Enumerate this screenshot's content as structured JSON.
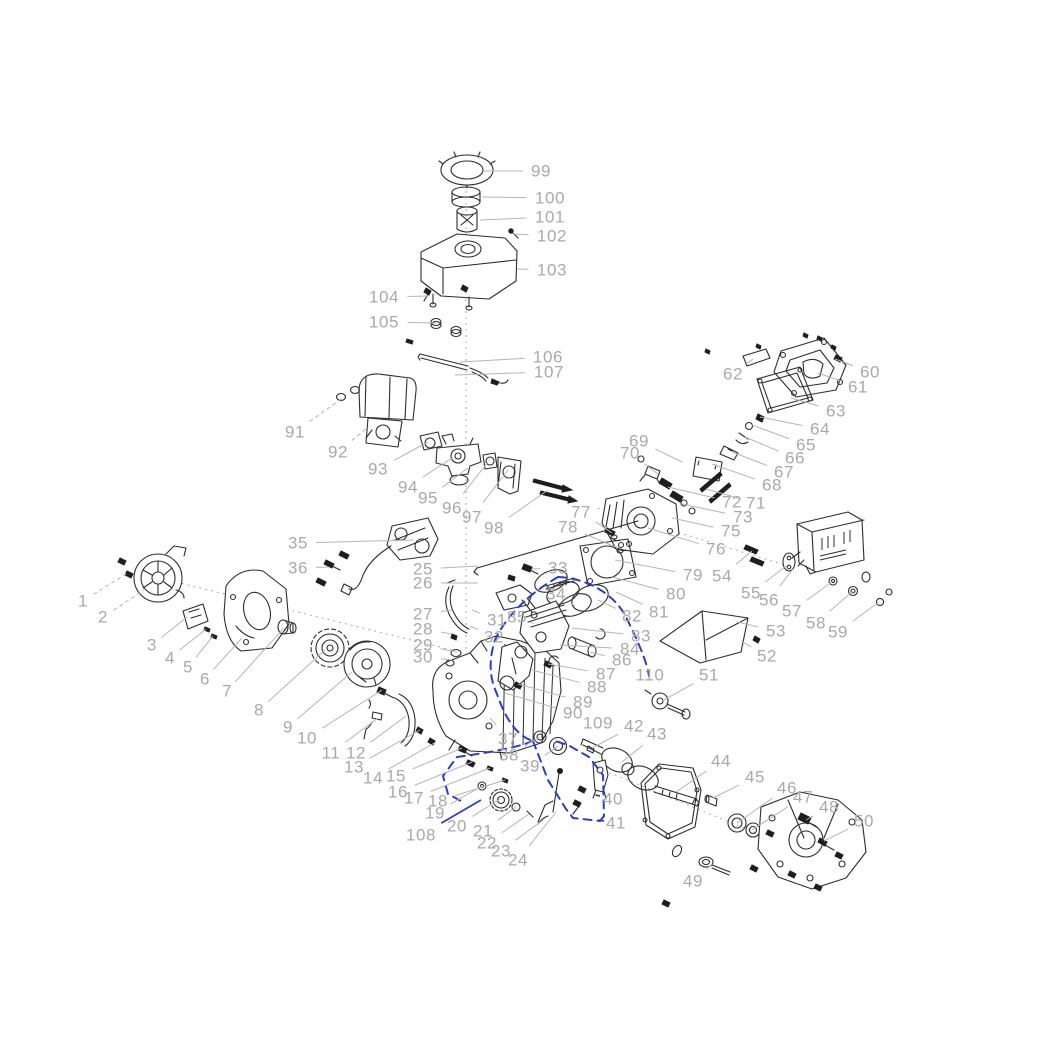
{
  "figure": {
    "type": "exploded-parts-diagram",
    "subject": "small gasoline engine"
  },
  "colors": {
    "background": "#ffffff",
    "label": "#a9a9a9",
    "leader": "#b5b5b5",
    "sketch": "#2d2d2d",
    "highlight": "#2a3bd0"
  },
  "axis_lines": [
    {
      "x1": 466,
      "y1": 185,
      "x2": 466,
      "y2": 652
    },
    {
      "x1": 176,
      "y1": 582,
      "x2": 452,
      "y2": 650
    },
    {
      "x1": 598,
      "y1": 508,
      "x2": 788,
      "y2": 566
    },
    {
      "x1": 598,
      "y1": 768,
      "x2": 756,
      "y2": 833
    }
  ],
  "highlight_paths": [
    {
      "d": "M558,577 C585,578 612,592 625,615 C638,641 647,662 649,676"
    },
    {
      "d": "M558,577 C535,590 508,612 495,640 C488,662 490,679 497,694 C506,720 517,736 533,741"
    },
    {
      "d": "M533,741 C514,749 478,754 457,757 L443,776 L448,794 L461,801"
    },
    {
      "d": "M533,741 L548,780 L566,809 L573,818 L600,821"
    },
    {
      "d": "M600,821 L604,816 L603,775 L589,757 L568,745 L552,740"
    }
  ],
  "callouts": [
    {
      "n": "1",
      "x": 83,
      "y": 601,
      "tx": 126,
      "ty": 574,
      "lt": "gd"
    },
    {
      "n": "2",
      "x": 103,
      "y": 617,
      "tx": 144,
      "ty": 590,
      "lt": "gd"
    },
    {
      "n": "3",
      "x": 152,
      "y": 645,
      "tx": 187,
      "ty": 617
    },
    {
      "n": "4",
      "x": 170,
      "y": 658,
      "tx": 206,
      "ty": 629
    },
    {
      "n": "5",
      "x": 188,
      "y": 667,
      "tx": 213,
      "ty": 636
    },
    {
      "n": "6",
      "x": 205,
      "y": 679,
      "tx": 242,
      "ty": 638
    },
    {
      "n": "7",
      "x": 227,
      "y": 691,
      "tx": 284,
      "ty": 628
    },
    {
      "n": "8",
      "x": 259,
      "y": 710,
      "tx": 325,
      "ty": 650
    },
    {
      "n": "9",
      "x": 288,
      "y": 727,
      "tx": 352,
      "ty": 672
    },
    {
      "n": "10",
      "x": 307,
      "y": 738,
      "tx": 382,
      "ty": 690
    },
    {
      "n": "11",
      "x": 331,
      "y": 753,
      "tx": 378,
      "ty": 718
    },
    {
      "n": "12",
      "x": 356,
      "y": 753,
      "tx": 406,
      "ty": 716
    },
    {
      "n": "13",
      "x": 354,
      "y": 767,
      "tx": 420,
      "ty": 730
    },
    {
      "n": "14",
      "x": 373,
      "y": 778,
      "tx": 436,
      "ty": 742
    },
    {
      "n": "15",
      "x": 396,
      "y": 776,
      "tx": 462,
      "ty": 748
    },
    {
      "n": "16",
      "x": 398,
      "y": 792,
      "tx": 472,
      "ty": 762
    },
    {
      "n": "17",
      "x": 414,
      "y": 798,
      "tx": 490,
      "ty": 768
    },
    {
      "n": "18",
      "x": 438,
      "y": 801,
      "tx": 505,
      "ty": 780
    },
    {
      "n": "19",
      "x": 435,
      "y": 813,
      "tx": 482,
      "ty": 786
    },
    {
      "n": "20",
      "x": 457,
      "y": 826,
      "tx": 500,
      "ty": 799
    },
    {
      "n": "21",
      "x": 483,
      "y": 831,
      "tx": 516,
      "ty": 807
    },
    {
      "n": "22",
      "x": 487,
      "y": 843,
      "tx": 529,
      "ty": 814
    },
    {
      "n": "23",
      "x": 501,
      "y": 851,
      "tx": 543,
      "ty": 820
    },
    {
      "n": "24",
      "x": 518,
      "y": 860,
      "tx": 556,
      "ty": 812
    },
    {
      "n": "25",
      "x": 423,
      "y": 569,
      "tx": 478,
      "ty": 566
    },
    {
      "n": "26",
      "x": 423,
      "y": 583,
      "tx": 478,
      "ty": 583
    },
    {
      "n": "27",
      "x": 423,
      "y": 614,
      "tx": 452,
      "ty": 610
    },
    {
      "n": "28",
      "x": 423,
      "y": 629,
      "tx": 452,
      "ty": 634
    },
    {
      "n": "29",
      "x": 423,
      "y": 645,
      "tx": 457,
      "ty": 652
    },
    {
      "n": "30",
      "x": 423,
      "y": 657,
      "tx": 452,
      "ty": 660
    },
    {
      "n": "31",
      "x": 497,
      "y": 620,
      "tx": 472,
      "ty": 610
    },
    {
      "n": "32",
      "x": 494,
      "y": 637,
      "tx": 470,
      "ty": 626
    },
    {
      "n": "33",
      "x": 558,
      "y": 568,
      "tx": 532,
      "ty": 569
    },
    {
      "n": "34",
      "x": 556,
      "y": 594,
      "tx": 575,
      "ty": 606
    },
    {
      "n": "35",
      "x": 298,
      "y": 543,
      "tx": 413,
      "ty": 540
    },
    {
      "n": "36",
      "x": 298,
      "y": 568,
      "tx": 329,
      "ty": 567
    },
    {
      "n": "37",
      "x": 508,
      "y": 739,
      "tx": 490,
      "ty": 718
    },
    {
      "n": "38",
      "x": 509,
      "y": 755,
      "tx": 540,
      "ty": 737
    },
    {
      "n": "39",
      "x": 530,
      "y": 766,
      "tx": 558,
      "ty": 746
    },
    {
      "n": "40",
      "x": 613,
      "y": 799,
      "tx": 600,
      "ty": 796,
      "lt": "b"
    },
    {
      "n": "41",
      "x": 616,
      "y": 823,
      "tx": 604,
      "ty": 821,
      "lt": "b"
    },
    {
      "n": "42",
      "x": 634,
      "y": 726,
      "tx": 592,
      "ty": 748
    },
    {
      "n": "43",
      "x": 657,
      "y": 734,
      "tx": 622,
      "ty": 762
    },
    {
      "n": "44",
      "x": 721,
      "y": 761,
      "tx": 676,
      "ty": 792
    },
    {
      "n": "45",
      "x": 755,
      "y": 777,
      "tx": 713,
      "ty": 798
    },
    {
      "n": "46",
      "x": 787,
      "y": 788,
      "tx": 737,
      "ty": 823
    },
    {
      "n": "47",
      "x": 803,
      "y": 797,
      "tx": 752,
      "ty": 830
    },
    {
      "n": "48",
      "x": 829,
      "y": 807,
      "tx": 806,
      "ty": 820
    },
    {
      "n": "49",
      "x": 693,
      "y": 881,
      "tx": 712,
      "ty": 864
    },
    {
      "n": "50",
      "x": 864,
      "y": 821,
      "tx": 824,
      "ty": 841
    },
    {
      "n": "51",
      "x": 709,
      "y": 675,
      "tx": 662,
      "ty": 701
    },
    {
      "n": "52",
      "x": 767,
      "y": 656,
      "tx": 741,
      "ty": 641
    },
    {
      "n": "53",
      "x": 776,
      "y": 631,
      "tx": 737,
      "ty": 622
    },
    {
      "n": "54",
      "x": 722,
      "y": 576,
      "tx": 752,
      "ty": 551
    },
    {
      "n": "55",
      "x": 751,
      "y": 593,
      "tx": 786,
      "ty": 566
    },
    {
      "n": "56",
      "x": 769,
      "y": 600,
      "tx": 793,
      "ty": 569
    },
    {
      "n": "57",
      "x": 792,
      "y": 611,
      "tx": 833,
      "ty": 581
    },
    {
      "n": "58",
      "x": 816,
      "y": 623,
      "tx": 853,
      "ty": 591
    },
    {
      "n": "59",
      "x": 838,
      "y": 632,
      "tx": 879,
      "ty": 602
    },
    {
      "n": "60",
      "x": 870,
      "y": 372,
      "tx": 835,
      "ty": 359
    },
    {
      "n": "61",
      "x": 858,
      "y": 387,
      "tx": 818,
      "ty": 373
    },
    {
      "n": "62",
      "x": 733,
      "y": 374,
      "tx": 753,
      "ty": 359
    },
    {
      "n": "63",
      "x": 836,
      "y": 411,
      "tx": 791,
      "ty": 398
    },
    {
      "n": "64",
      "x": 820,
      "y": 429,
      "tx": 760,
      "ty": 417
    },
    {
      "n": "65",
      "x": 806,
      "y": 445,
      "tx": 752,
      "ty": 425
    },
    {
      "n": "66",
      "x": 795,
      "y": 458,
      "tx": 745,
      "ty": 437
    },
    {
      "n": "67",
      "x": 784,
      "y": 472,
      "tx": 732,
      "ty": 452
    },
    {
      "n": "68",
      "x": 772,
      "y": 485,
      "tx": 712,
      "ty": 464
    },
    {
      "n": "69",
      "x": 639,
      "y": 441,
      "tx": 682,
      "ty": 462
    },
    {
      "n": "70",
      "x": 630,
      "y": 453,
      "tx": 658,
      "ty": 474
    },
    {
      "n": "71",
      "x": 756,
      "y": 503,
      "tx": 706,
      "ty": 489
    },
    {
      "n": "72",
      "x": 732,
      "y": 502,
      "tx": 668,
      "ty": 487
    },
    {
      "n": "73",
      "x": 743,
      "y": 517,
      "tx": 682,
      "ty": 504
    },
    {
      "n": "75",
      "x": 731,
      "y": 531,
      "tx": 672,
      "ty": 518
    },
    {
      "n": "76",
      "x": 716,
      "y": 549,
      "tx": 648,
      "ty": 528
    },
    {
      "n": "77",
      "x": 581,
      "y": 512,
      "tx": 612,
      "ty": 533
    },
    {
      "n": "78",
      "x": 568,
      "y": 527,
      "tx": 618,
      "ty": 548
    },
    {
      "n": "79",
      "x": 693,
      "y": 575,
      "tx": 615,
      "ty": 560
    },
    {
      "n": "80",
      "x": 676,
      "y": 594,
      "tx": 612,
      "ty": 577
    },
    {
      "n": "81",
      "x": 659,
      "y": 612,
      "tx": 616,
      "ty": 592
    },
    {
      "n": "82",
      "x": 632,
      "y": 616,
      "tx": 598,
      "ty": 600
    },
    {
      "n": "83",
      "x": 641,
      "y": 636,
      "tx": 572,
      "ty": 628
    },
    {
      "n": "84",
      "x": 630,
      "y": 649,
      "tx": 560,
      "ty": 645
    },
    {
      "n": "85",
      "x": 517,
      "y": 617,
      "tx": 530,
      "ty": 622
    },
    {
      "n": "86",
      "x": 622,
      "y": 660,
      "tx": 590,
      "ty": 652
    },
    {
      "n": "87",
      "x": 606,
      "y": 674,
      "tx": 548,
      "ty": 664
    },
    {
      "n": "88",
      "x": 597,
      "y": 687,
      "tx": 532,
      "ty": 670
    },
    {
      "n": "89",
      "x": 583,
      "y": 702,
      "tx": 518,
      "ty": 684
    },
    {
      "n": "90",
      "x": 573,
      "y": 713,
      "tx": 505,
      "ty": 693
    },
    {
      "n": "91",
      "x": 295,
      "y": 432,
      "tx": 344,
      "ty": 397,
      "lt": "gd"
    },
    {
      "n": "92",
      "x": 338,
      "y": 452,
      "tx": 367,
      "ty": 428,
      "lt": "gd"
    },
    {
      "n": "93",
      "x": 378,
      "y": 469,
      "tx": 428,
      "ty": 442
    },
    {
      "n": "94",
      "x": 408,
      "y": 487,
      "tx": 452,
      "ty": 458
    },
    {
      "n": "95",
      "x": 428,
      "y": 498,
      "tx": 468,
      "ty": 468
    },
    {
      "n": "96",
      "x": 452,
      "y": 508,
      "tx": 488,
      "ty": 462
    },
    {
      "n": "97",
      "x": 472,
      "y": 517,
      "tx": 508,
      "ty": 470
    },
    {
      "n": "98",
      "x": 494,
      "y": 528,
      "tx": 548,
      "ty": 490
    },
    {
      "n": "99",
      "x": 541,
      "y": 171,
      "tx": 483,
      "ty": 171
    },
    {
      "n": "100",
      "x": 550,
      "y": 198,
      "tx": 482,
      "ty": 197
    },
    {
      "n": "101",
      "x": 550,
      "y": 217,
      "tx": 480,
      "ty": 220
    },
    {
      "n": "102",
      "x": 552,
      "y": 236,
      "tx": 513,
      "ty": 234
    },
    {
      "n": "103",
      "x": 552,
      "y": 270,
      "tx": 517,
      "ty": 269
    },
    {
      "n": "104",
      "x": 384,
      "y": 297,
      "tx": 428,
      "ty": 296
    },
    {
      "n": "105",
      "x": 384,
      "y": 322,
      "tx": 436,
      "ty": 323
    },
    {
      "n": "106",
      "x": 548,
      "y": 357,
      "tx": 460,
      "ty": 362
    },
    {
      "n": "107",
      "x": 549,
      "y": 372,
      "tx": 455,
      "ty": 375
    },
    {
      "n": "108",
      "x": 421,
      "y": 835,
      "tx": 481,
      "ty": 800,
      "lt": "bs"
    },
    {
      "n": "109",
      "x": 598,
      "y": 723
    },
    {
      "n": "110",
      "x": 650,
      "y": 675
    }
  ]
}
